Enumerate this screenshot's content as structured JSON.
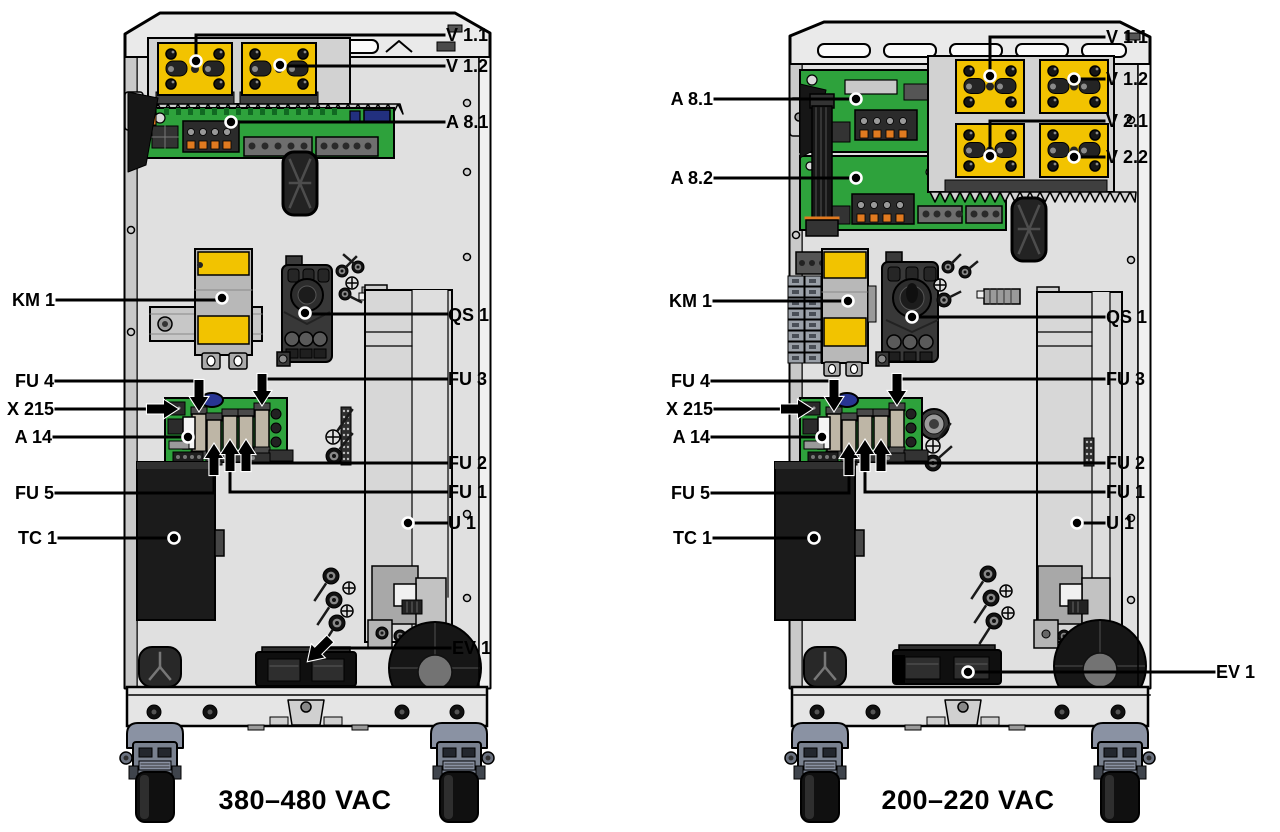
{
  "colors": {
    "module_yellow": "#F2C300",
    "pcb_green": "#2EA23C",
    "cabinet_fill": "#EAEAEA",
    "interior_fill": "#E0E0E0",
    "dark_component": "#1B1B1B",
    "caster_gray_blue": "#79818F",
    "leader_line": "#000000",
    "label_text": "#000000"
  },
  "figures": [
    {
      "id": "cabinet-380-480",
      "caption": "380–480 VAC",
      "callouts": [
        {
          "id": "v11",
          "label": "V 1.1"
        },
        {
          "id": "v12",
          "label": "V 1.2"
        },
        {
          "id": "a81",
          "label": "A 8.1"
        },
        {
          "id": "km1",
          "label": "KM 1"
        },
        {
          "id": "qs1",
          "label": "QS 1"
        },
        {
          "id": "fu4",
          "label": "FU 4"
        },
        {
          "id": "fu3",
          "label": "FU 3"
        },
        {
          "id": "x215",
          "label": "X 215"
        },
        {
          "id": "a14",
          "label": "A 14"
        },
        {
          "id": "fu2",
          "label": "FU 2"
        },
        {
          "id": "fu5",
          "label": "FU 5"
        },
        {
          "id": "fu1",
          "label": "FU 1"
        },
        {
          "id": "u1",
          "label": "U 1"
        },
        {
          "id": "tc1",
          "label": "TC 1"
        },
        {
          "id": "ev1",
          "label": "EV 1"
        }
      ]
    },
    {
      "id": "cabinet-200-220",
      "caption": "200–220 VAC",
      "callouts": [
        {
          "id": "v11",
          "label": "V 1.1"
        },
        {
          "id": "v12",
          "label": "V 1.2"
        },
        {
          "id": "a81",
          "label": "A 8.1"
        },
        {
          "id": "v21",
          "label": "V 2.1"
        },
        {
          "id": "v22",
          "label": "V 2.2"
        },
        {
          "id": "a82",
          "label": "A 8.2"
        },
        {
          "id": "km1",
          "label": "KM 1"
        },
        {
          "id": "qs1",
          "label": "QS 1"
        },
        {
          "id": "fu4",
          "label": "FU 4"
        },
        {
          "id": "fu3",
          "label": "FU 3"
        },
        {
          "id": "x215",
          "label": "X 215"
        },
        {
          "id": "a14",
          "label": "A 14"
        },
        {
          "id": "fu2",
          "label": "FU 2"
        },
        {
          "id": "fu5",
          "label": "FU 5"
        },
        {
          "id": "fu1",
          "label": "FU 1"
        },
        {
          "id": "u1",
          "label": "U 1"
        },
        {
          "id": "tc1",
          "label": "TC 1"
        },
        {
          "id": "ev1",
          "label": "EV 1"
        }
      ]
    }
  ]
}
